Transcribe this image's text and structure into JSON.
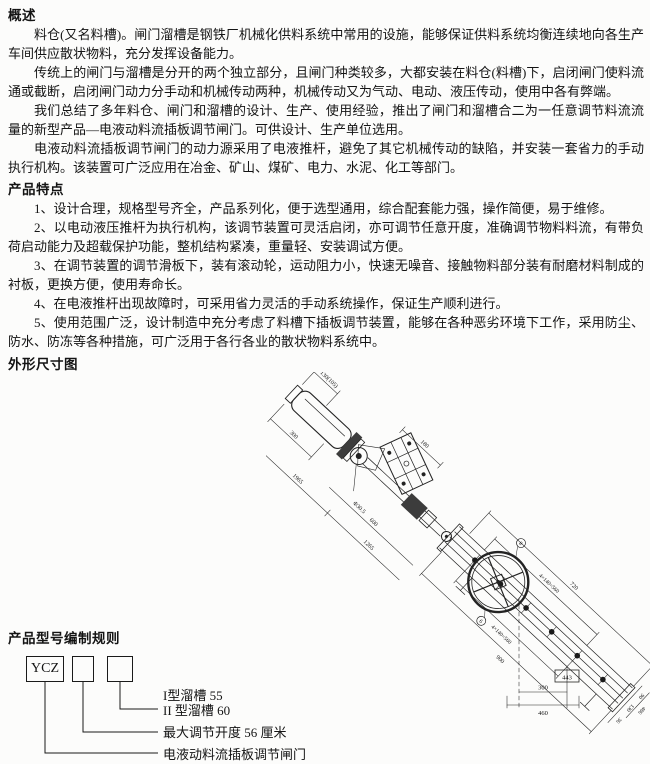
{
  "doc": {
    "overview": {
      "heading": "概述",
      "paragraphs": [
        "料仓(又名料槽)。闸门溜槽是钢铁厂机械化供料系统中常用的设施，能够保证供料系统均衡连续地向各生产车间供应散状物料，充分发挥设备能力。",
        "传统上的闸门与溜槽是分开的两个独立部分，且闸门种类较多，大都安装在料仓(料槽)下，启闭闸门使料流通或截断，启闭闸门动力分手动和机械传动两种，机械传动又为气动、电动、液压传动，使用中各有弊端。",
        "我们总结了多年料仓、闸门和溜槽的设计、生产、使用经验，推出了闸门和溜槽合二为一任意调节料流流量的新型产品—电液动料流插板调节闸门。可供设计、生产单位选用。",
        "电液动料流插板调节闸门的动力源采用了电液推杆，避免了其它机械传动的缺陷，并安装一套省力的手动执行机构。该装置可广泛应用在冶金、矿山、煤矿、电力、水泥、化工等部门。"
      ]
    },
    "features": {
      "heading": "产品特点",
      "items": [
        "1、设计合理，规格型号齐全，产品系列化，便于选型通用，综合配套能力强，操作简便，易于维修。",
        "2、以电动液压推杆为执行机构，该调节装置可灵活启闭，亦可调节任意开度，准确调节物料料流，有带负荷启动能力及超载保护功能，整机结构紧凑，重量轻、安装调试方便。",
        "3、在调节装置的调节滑板下，装有滚动轮，运动阻力小，快速无噪音、接触物料部分装有耐磨材料制成的衬板，更换方便，使用寿命长。",
        "4、在电液推杆出现故障时，可采用省力灵活的手动系统操作，保证生产顺利进行。",
        "5、使用范围广泛，设计制造中充分考虑了料槽下插板调节装置，能够在各种恶劣环境下工作，采用防尘、防水、防冻等各种措施，可广泛用于各行各业的散状物料系统中。"
      ]
    },
    "dimension_section": {
      "heading": "外形尺寸图"
    },
    "model_section": {
      "heading": "产品型号编制规则",
      "code": "YCZ",
      "labels": {
        "type1": "I型溜槽 55",
        "type2": "II 型溜槽 60",
        "opening": "最大调节开度 56 厘米",
        "name": "电液动料流插板调节闸门"
      }
    }
  },
  "drawing": {
    "dims": {
      "d130_105": "130(105)",
      "d300_top": "300",
      "d180": "180",
      "dphi": "Φ30.5",
      "d600": "600",
      "d1965": "1965",
      "d1265": "1265",
      "d720": "720",
      "d560_top": "4×140=560",
      "d560_bottom": "4×140=560",
      "d900": "900",
      "d90": "90",
      "d130_right": "130",
      "d36": "36",
      "d486": "486",
      "d443": "443",
      "d300_bottom": "300",
      "d460": "460"
    },
    "balloons": {
      "b8": "8",
      "b6": "6"
    }
  }
}
